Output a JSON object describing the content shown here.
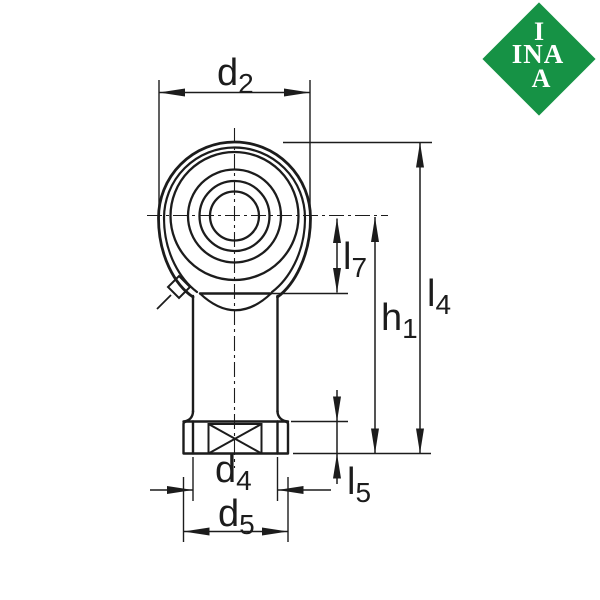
{
  "logo": {
    "top_letter": "I",
    "middle_letters": "INA",
    "bottom_letter": "A",
    "background_color": "#169245",
    "letter_color": "#ffffff"
  },
  "drawing": {
    "line_color": "#1c1c1c",
    "background": "#ffffff",
    "part": "rod-end-with-female-thread-front-and-side-view",
    "dimensions": [
      {
        "id": "d2",
        "main": "d",
        "sub": "2"
      },
      {
        "id": "l7",
        "main": "l",
        "sub": "7"
      },
      {
        "id": "h1",
        "main": "h",
        "sub": "1"
      },
      {
        "id": "l4",
        "main": "l",
        "sub": "4"
      },
      {
        "id": "d4",
        "main": "d",
        "sub": "4"
      },
      {
        "id": "l5",
        "main": "l",
        "sub": "5"
      },
      {
        "id": "d5",
        "main": "d",
        "sub": "5"
      }
    ]
  }
}
